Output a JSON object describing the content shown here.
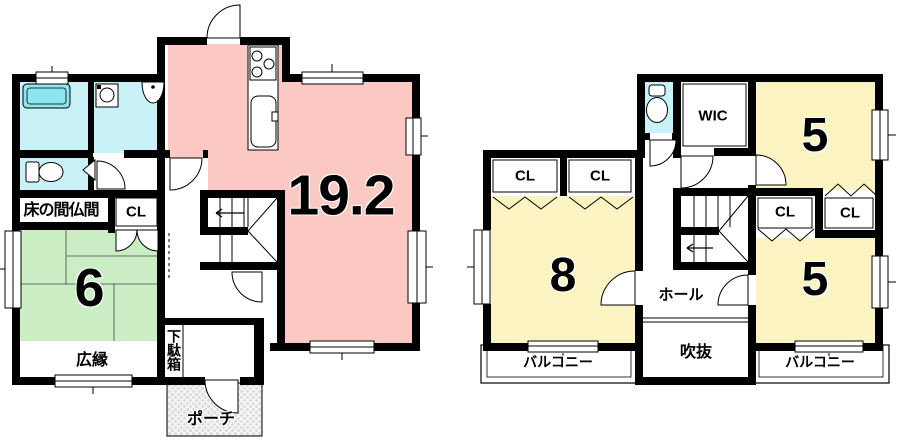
{
  "colors": {
    "wall": "#000000",
    "ldk": "#FBC8C4",
    "tatami": "#CBEDC3",
    "bedroom": "#FCF3C2",
    "wet_area": "#C9F1F8",
    "bathtub": "#8BE6F0",
    "porch": "#DCDCDC"
  },
  "floor1": {
    "ldk_area": "19.2",
    "washitsu_area": "6",
    "tokonoma_label": "床の間仏間",
    "closet_label": "CL",
    "hiroen_label": "広縁",
    "getabako_label": "下駄箱",
    "porch_label": "ポーチ"
  },
  "floor2": {
    "room8_area": "8",
    "room5_top_area": "5",
    "room5_bottom_area": "5",
    "wic_label": "WIC",
    "closets": [
      "CL",
      "CL",
      "CL",
      "CL"
    ],
    "hall_label": "ホール",
    "void_label": "吹抜",
    "balcony_left_label": "バルコニー",
    "balcony_right_label": "バルコニー"
  }
}
